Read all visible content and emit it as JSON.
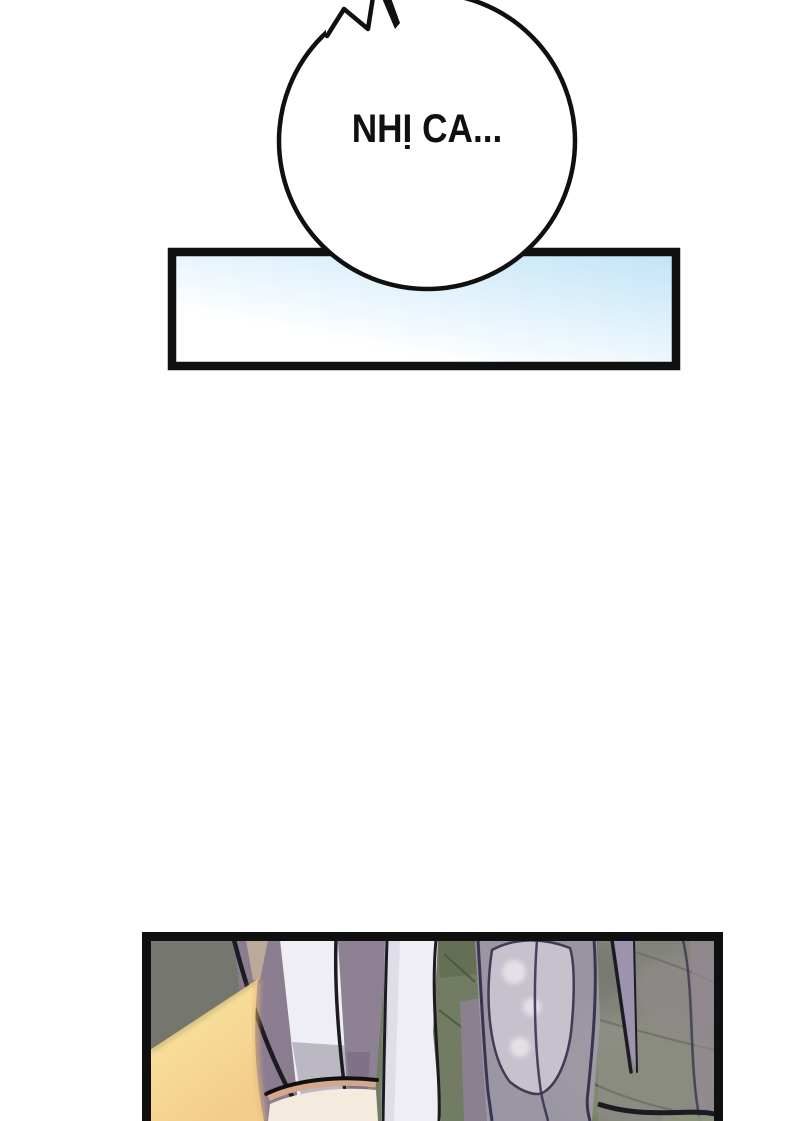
{
  "speech_bubble": {
    "text": "NHỊ CA..."
  },
  "theme": {
    "paper": "#ffffff",
    "ink": "#101010",
    "ink_soft": "#1c1a22",
    "panel_gradient_start": "#ffffff",
    "panel_gradient_end": "#c6e6f8",
    "olive": "#717c62",
    "olive_dark": "#59644a",
    "olive_light": "#8d957a",
    "olive_line": "#4d5841",
    "olive_shadow": "#8d7c57",
    "stone": "#74766f",
    "stone_light": "#98918e",
    "mauve": "#8d8193",
    "mauve_deep": "#7b6f86",
    "mauve_dim": "#8a7d90",
    "mauve_overlay": "#968b97",
    "lavender": "#9e93ae",
    "white_fabric": "#efeef4",
    "white_fabric_shade": "#dbd9e5",
    "fabric_shade": "#aaa5b4",
    "violet": "#a29cae",
    "violet_light": "#cbc5d1",
    "violet_line": "#3a3450",
    "yellow_light": "#fae9a2",
    "yellow_deep": "#f3cd8a",
    "yellow_edge": "#e9b878",
    "yellow_glow": "#ead9a0",
    "skin": "#d5a88c",
    "skin_light": "#f4eade"
  }
}
